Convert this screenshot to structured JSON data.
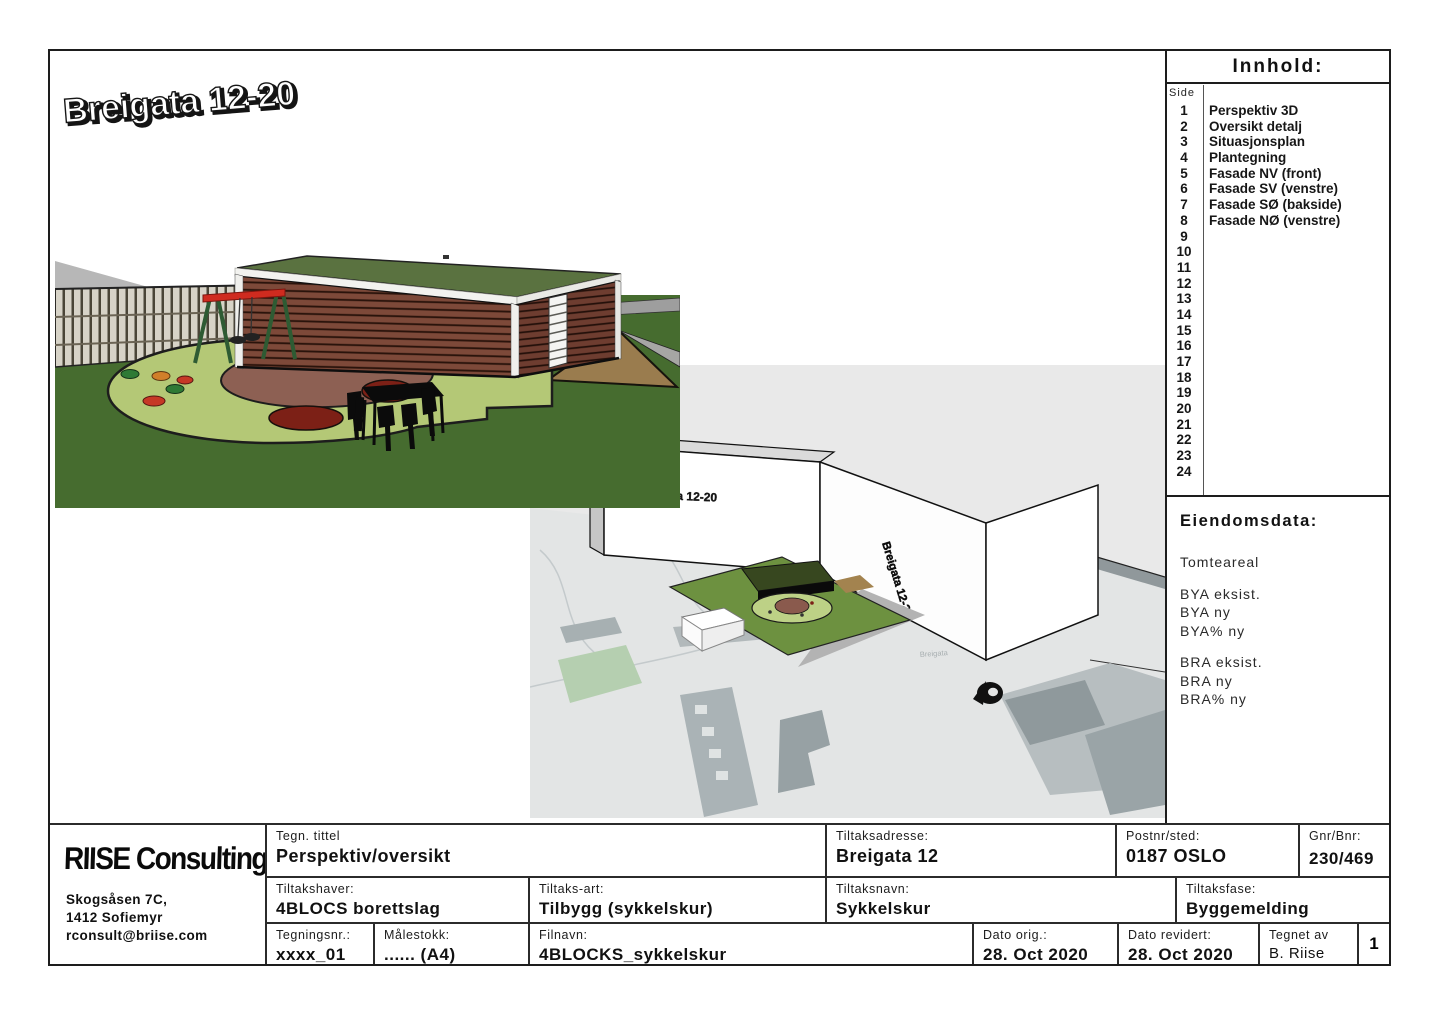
{
  "page_title": "Breigata 12-20",
  "innhold": {
    "title": "Innhold:",
    "side_label": "Side",
    "items": [
      {
        "page": "1",
        "label": "Perspektiv 3D"
      },
      {
        "page": "2",
        "label": "Oversikt detalj"
      },
      {
        "page": "3",
        "label": "Situasjonsplan"
      },
      {
        "page": "4",
        "label": "Plantegning"
      },
      {
        "page": "5",
        "label": "Fasade NV (front)"
      },
      {
        "page": "6",
        "label": "Fasade SV (venstre)"
      },
      {
        "page": "7",
        "label": "Fasade SØ (bakside)"
      },
      {
        "page": "8",
        "label": "Fasade NØ (venstre)"
      },
      {
        "page": "9",
        "label": ""
      },
      {
        "page": "10",
        "label": ""
      },
      {
        "page": "11",
        "label": ""
      },
      {
        "page": "12",
        "label": ""
      },
      {
        "page": "13",
        "label": ""
      },
      {
        "page": "14",
        "label": ""
      },
      {
        "page": "15",
        "label": ""
      },
      {
        "page": "16",
        "label": ""
      },
      {
        "page": "17",
        "label": ""
      },
      {
        "page": "18",
        "label": ""
      },
      {
        "page": "19",
        "label": ""
      },
      {
        "page": "20",
        "label": ""
      },
      {
        "page": "21",
        "label": ""
      },
      {
        "page": "22",
        "label": ""
      },
      {
        "page": "23",
        "label": ""
      },
      {
        "page": "24",
        "label": ""
      }
    ]
  },
  "eiendomsdata": {
    "title": "Eiendomsdata:",
    "tomteareal": "Tomteareal",
    "bya": [
      "BYA eksist.",
      "BYA ny",
      "BYA% ny"
    ],
    "bra": [
      "BRA eksist.",
      "BRA ny",
      "BRA% ny"
    ]
  },
  "overview": {
    "building_label": "Breigata 12-20",
    "building_label_side": "Breigata 12-20",
    "map_label": "Breigata"
  },
  "titleblock": {
    "company": {
      "name": "RIISE Consulting",
      "address1": "Skogsåsen 7C,",
      "address2": "1412 Sofiemyr",
      "email": "rconsult@briise.com"
    },
    "tegn_tittel": {
      "label": "Tegn. tittel",
      "value": "Perspektiv/oversikt"
    },
    "tiltaksadresse": {
      "label": "Tiltaksadresse:",
      "value": "Breigata 12"
    },
    "postnr": {
      "label": "Postnr/sted:",
      "value": "0187 OSLO"
    },
    "gnr": {
      "label": "Gnr/Bnr:",
      "value": "230/469"
    },
    "tiltakshaver": {
      "label": "Tiltakshaver:",
      "value": "4BLOCS borettslag"
    },
    "tiltaksart": {
      "label": "Tiltaks-art:",
      "value": "Tilbygg (sykkelskur)"
    },
    "tiltaksnavn": {
      "label": "Tiltaksnavn:",
      "value": "Sykkelskur"
    },
    "tiltaksfase": {
      "label": "Tiltaksfase:",
      "value": "Byggemelding"
    },
    "tegningsnr": {
      "label": "Tegningsnr.:",
      "value": "xxxx_01"
    },
    "malestokk": {
      "label": "Målestokk:",
      "value": "...... (A4)"
    },
    "filnavn": {
      "label": "Filnavn:",
      "value": "4BLOCKS_sykkelskur"
    },
    "dato_orig": {
      "label": "Dato orig.:",
      "value": "28. Oct 2020"
    },
    "dato_revidert": {
      "label": "Dato revidert:",
      "value": "28. Oct 2020"
    },
    "tegnet_av": {
      "label": "Tegnet av",
      "value": "B. Riise"
    },
    "page_num": {
      "value": "1"
    }
  },
  "colors": {
    "shed_roof_green": "#5a7240",
    "shed_slats_brown": "#7d4939",
    "grass_dark": "#466c2f",
    "playground_green": "#b4c876",
    "playground_mauve": "#8d6053",
    "playground_red": "#7c2016",
    "sand_tan": "#9a7c4e",
    "courtyard_green": "#6d9140",
    "sky_grey": "#e9e9e9"
  }
}
